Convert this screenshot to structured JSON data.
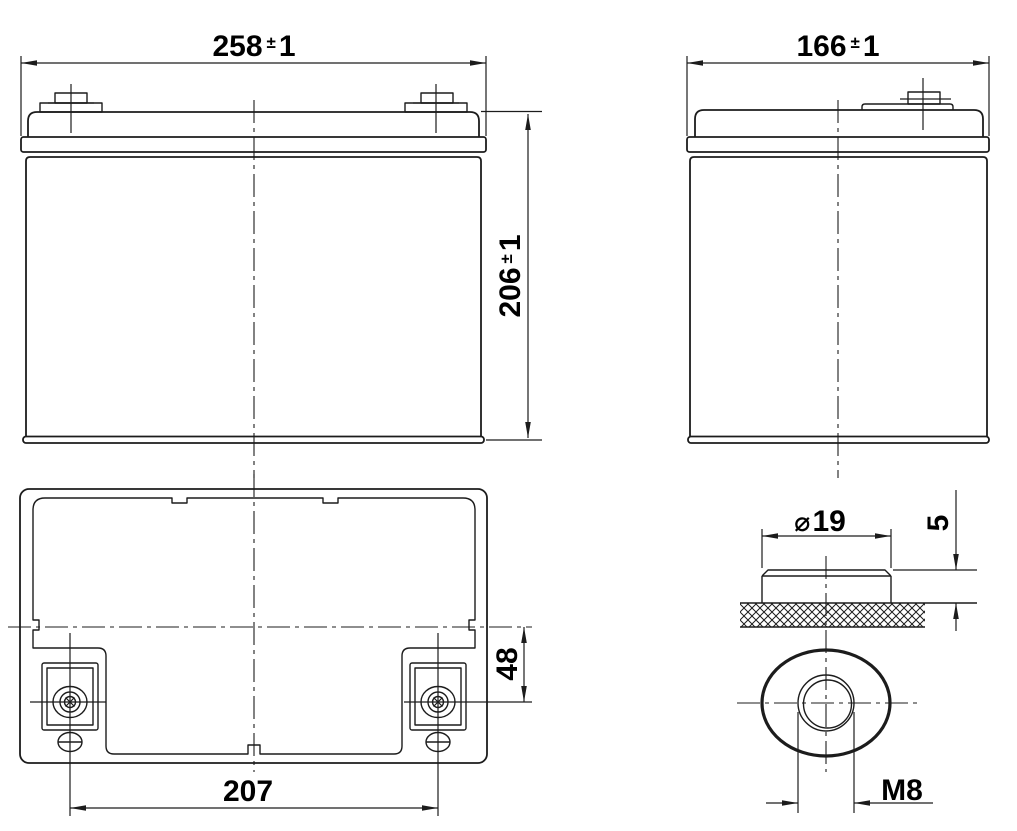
{
  "drawing": {
    "description": "Battery dimensional outline drawing with front view, side view, top view and terminal details",
    "ink_color": "#1c1c1c",
    "background_color": "#ffffff",
    "dims": {
      "length": {
        "value": "258",
        "pm": "±",
        "tol": "1"
      },
      "height": {
        "value": "206",
        "pm": "±",
        "tol": "1"
      },
      "width": {
        "value": "166",
        "pm": "±",
        "tol": "1"
      },
      "terminal_pitch": {
        "value": "207"
      },
      "terminal_offset": {
        "value": "48"
      },
      "terminal_diameter": {
        "symbol": "⌀",
        "value": "19"
      },
      "terminal_height": {
        "value": "5"
      },
      "terminal_thread": {
        "value": "M8"
      }
    }
  }
}
